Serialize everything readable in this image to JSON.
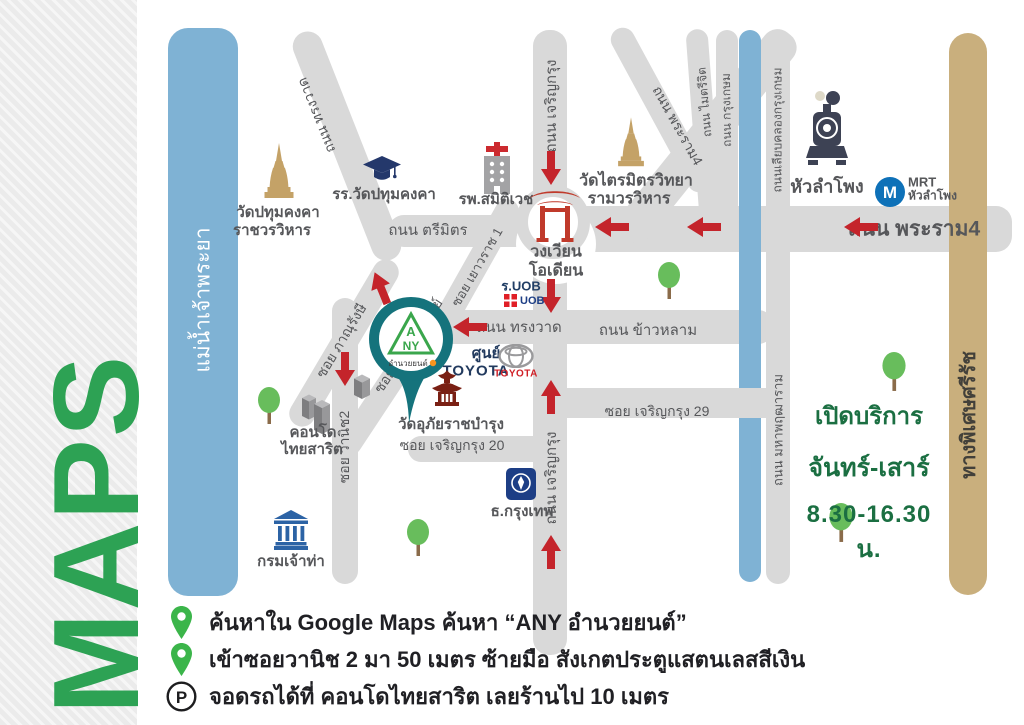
{
  "page_title": "MAPS",
  "colors": {
    "brand_green": "#2da254",
    "pin_green": "#3bb54a",
    "river_blue": "#7fb2d4",
    "road_gray": "#d9d9d9",
    "expressway_tan": "#c9af7d",
    "arrow_red": "#c4242b",
    "shop_teal": "#15737c",
    "hours_green": "#1b6f42"
  },
  "river": {
    "label": "แม่น้ำเจ้าพระยา"
  },
  "expressway": {
    "label": "ทางพิเศษศรีรัช"
  },
  "roads": {
    "songwat_diag": "ถนน ทรงวาด",
    "trimit": "ถนน ตรีมิตร",
    "songwat_h": "ถนน ทรงวาด",
    "khaolam": "ถนน ข้าวหลาม",
    "charoenkrung_top": "ถนน เจริญกรุง",
    "charoenkrung_bottom": "ถนน เจริญกรุง",
    "rama4_diag": "ถนน พระราม4",
    "rama4_h": "ถนน พระราม4",
    "maitrichit": "ถนน ไมตรีจิต",
    "krungkasem": "ถนน กรุงเกษม",
    "liapkhlong": "ถนนเลียบคลองกรุงเกษม",
    "mahaphruttharam": "ถนน มหาพฤฒาราม",
    "yaowarat1": "ซอย เยาวราช 1",
    "phanurangsi": "ซอย ภาณุรังษี",
    "charoenphanit": "ซอย เจริญพาณิชย์",
    "wanit2": "ซอย วานิช2",
    "charoenkrung20": "ซอย เจริญกรุง 20",
    "charoenkrung29": "ซอย เจริญกรุง 29"
  },
  "landmarks": {
    "wat_pathum": {
      "line1": "วัดปทุมคงคา",
      "line2": "ราชวรวิหาร"
    },
    "school": {
      "label": "รร.วัดปทุมคงคา"
    },
    "hospital": {
      "label": "รพ.สมิติเวช"
    },
    "wat_traimit": {
      "line1": "วัดไตรมิตรวิทยา",
      "line2": "รามวรวิหาร"
    },
    "odeon": {
      "line1": "วงเวียน",
      "line2": "โอเดียน"
    },
    "hua_lamphong": {
      "label": "หัวลำโพง"
    },
    "mrt": {
      "m": "M",
      "line1": "MRT",
      "line2": "หัวลำโพง"
    },
    "uob": {
      "label": "ร.UOB",
      "logo": "UOB"
    },
    "toyota": {
      "line1": "ศูนย์",
      "line2": "TOYOTA",
      "logo_text": "TOYOTA"
    },
    "wat_uphai": {
      "line1": "วัดอุภัยราชบำรุง"
    },
    "condo": {
      "line1": "คอนโด",
      "line2": "ไทยสาริต"
    },
    "marine_dept": {
      "label": "กรมเจ้าท่า"
    },
    "bangkok_bank": {
      "label": "ธ.กรุงเทพ"
    }
  },
  "any_pin": {
    "a": "A",
    "ny": "NY",
    "caption": "อำนวยยนต์"
  },
  "hours": {
    "line1": "เปิดบริการ",
    "line2": "จันทร์-เสาร์",
    "line3": "8.30-16.30 น."
  },
  "legend": {
    "item1": "ค้นหาใน Google Maps ค้นหา “ANY อำนวยยนต์”",
    "item2": "เข้าซอยวานิช 2 มา 50 เมตร ซ้ายมือ สังเกตประตูแสตนเลสสีเงิน",
    "item3": "จอดรถได้ที่ คอนโดไทยสาริต เลยร้านไป 10 เมตร",
    "parking_symbol": "P"
  }
}
